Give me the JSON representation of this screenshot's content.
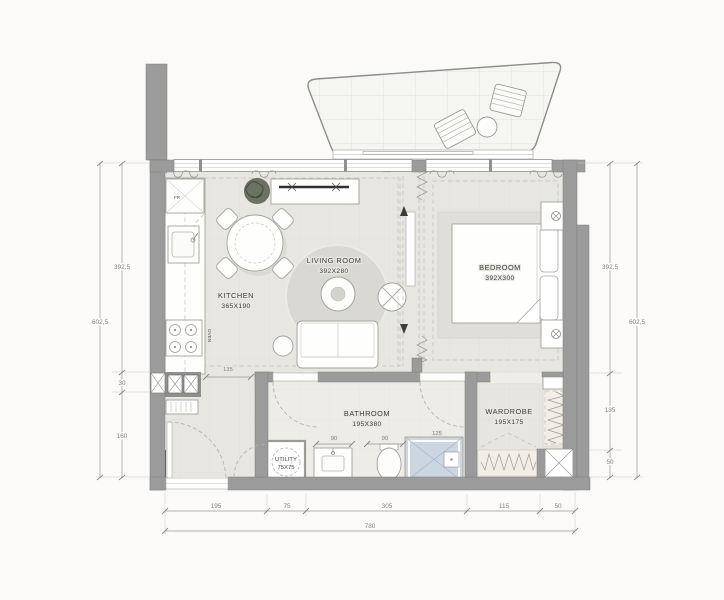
{
  "plan_type": "apartment-floor-plan",
  "rooms": {
    "kitchen": {
      "name": "KITCHEN",
      "size": "365X190"
    },
    "living": {
      "name": "LIVING ROOM",
      "size": "392X280"
    },
    "bedroom": {
      "name": "BEDROOM",
      "size": "392X300"
    },
    "bathroom": {
      "name": "BATHROOM",
      "size": "195X380"
    },
    "wardrobe": {
      "name": "WARDROBE",
      "size": "195X175"
    },
    "utility": {
      "name": "UTILITY",
      "size": "75X75"
    }
  },
  "appliances": {
    "fridge": "FR",
    "oven": "OVEN"
  },
  "dimensions": {
    "left": {
      "total": "602,5",
      "segments": [
        "392,5",
        "30",
        "160"
      ]
    },
    "right": {
      "total": "602,5",
      "segments": [
        "392,5",
        "135",
        "50"
      ]
    },
    "bottom": {
      "total": "780",
      "segments": [
        "195",
        "75",
        "305",
        "115",
        "50"
      ]
    },
    "interior": {
      "hall": "135",
      "vanity": "90",
      "toilet": "90",
      "shower": "125"
    }
  },
  "colors": {
    "wall": "#9b9b9b",
    "floor": "#e8e6e1",
    "bathroom_floor": "#edece7",
    "shower": "#ccd6e2",
    "rug": "#d9d8d3",
    "rail_strip": "#f2eee5",
    "plant": "#6b7263",
    "balcony": "#f5f5f2"
  }
}
